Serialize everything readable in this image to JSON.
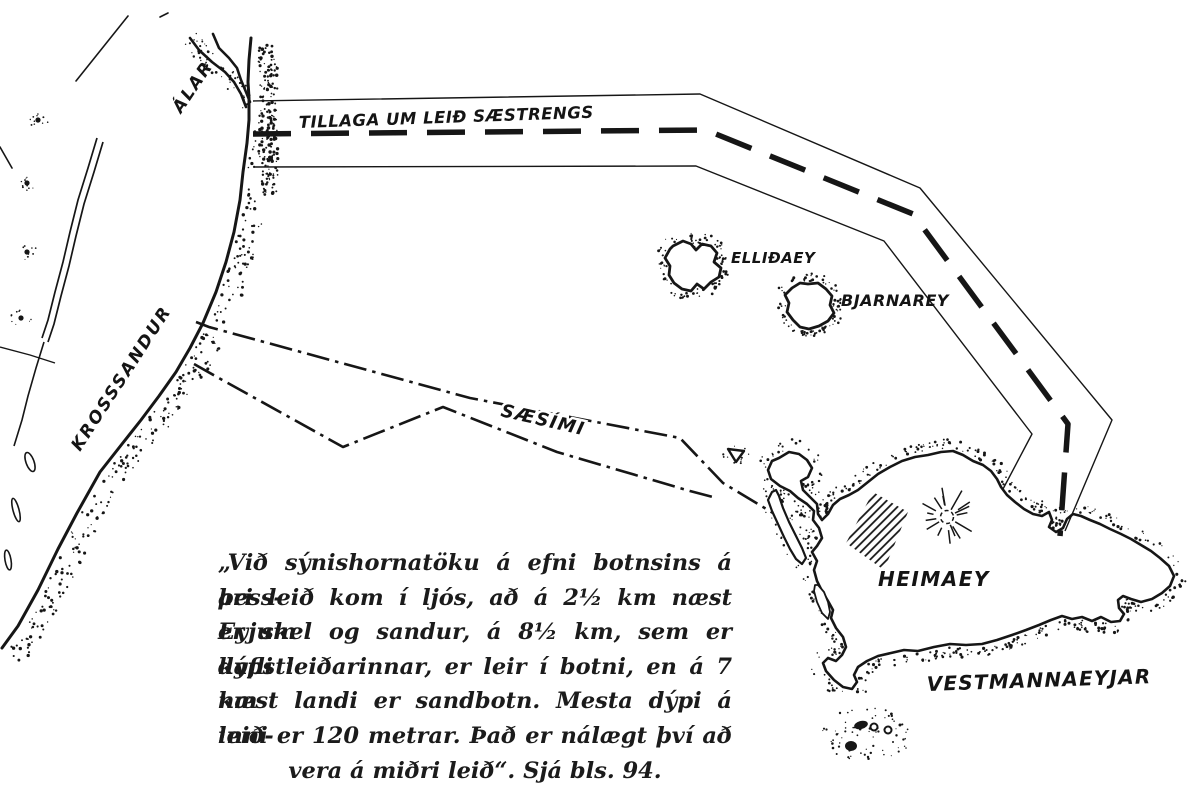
{
  "colors": {
    "ink": "#161616",
    "paper": "#ffffff"
  },
  "labels": {
    "alar": "ÁLAR",
    "tillaga": "TILLAGA UM LEIÐ SÆSTRENGS",
    "krosssandur": "KROSSSANDUR",
    "saesimi": "SÆSÍMI",
    "ellidaey": "ELLIÐAEY",
    "bjarnarey": "BJARNAREY",
    "heimaey": "HEIMAEY",
    "vestmannaeyjar": "VESTMANNAEYJAR"
  },
  "caption": {
    "lines": [
      "„Við sýnishornatöku á efni botnsins á þess-",
      "ari leið kom í ljós, að á 2½ km næst Eyjum",
      "er skel og sandur, á 8½ km, sem er dýpsti",
      "kafli leiðarinnar, er leir í botni, en á 7 km",
      "næst landi er sandbotn. Mesta dýpi á leið-",
      "inni er 120 metrar. Það er nálægt því að",
      "vera á miðri leið“. Sjá bls. 94."
    ]
  },
  "routes": {
    "proposed_sea_cable": {
      "label": "TILLAGA UM LEIÐ SÆSTRENGS",
      "style": "dashed",
      "center": [
        [
          253,
          134
        ],
        [
          706,
          130
        ],
        [
          913,
          214
        ],
        [
          1068,
          424
        ],
        [
          1060,
          536
        ]
      ],
      "upper": [
        [
          253,
          101
        ],
        [
          700,
          94
        ],
        [
          920,
          188
        ],
        [
          1112,
          420
        ],
        [
          1065,
          531
        ]
      ],
      "lower": [
        [
          255,
          167
        ],
        [
          696,
          166
        ],
        [
          884,
          241
        ],
        [
          1032,
          434
        ],
        [
          1003,
          489
        ]
      ]
    },
    "sea_telephone_upper": {
      "label": "SÆSÍMI",
      "style": "dash-dot",
      "points": [
        [
          196,
          322
        ],
        [
          209,
          327
        ],
        [
          470,
          398
        ],
        [
          680,
          438
        ],
        [
          723,
          483
        ],
        [
          773,
          513
        ]
      ]
    },
    "sea_telephone_lower": {
      "style": "dash-dot",
      "points": [
        [
          194,
          364
        ],
        [
          217,
          377
        ],
        [
          343,
          447
        ],
        [
          443,
          407
        ],
        [
          557,
          452
        ],
        [
          690,
          491
        ],
        [
          713,
          497
        ]
      ]
    }
  },
  "geometry": {
    "coast": [
      [
        251,
        38
      ],
      [
        249,
        60
      ],
      [
        248,
        82
      ],
      [
        249,
        98
      ],
      [
        249,
        120
      ],
      [
        247,
        143
      ],
      [
        243,
        172
      ],
      [
        240,
        200
      ],
      [
        234,
        232
      ],
      [
        226,
        262
      ],
      [
        216,
        292
      ],
      [
        203,
        323
      ],
      [
        190,
        348
      ],
      [
        176,
        372
      ],
      [
        159,
        396
      ],
      [
        141,
        420
      ],
      [
        122,
        444
      ],
      [
        100,
        472
      ],
      [
        77,
        513
      ],
      [
        58,
        549
      ],
      [
        38,
        590
      ],
      [
        18,
        626
      ],
      [
        2,
        648
      ]
    ],
    "channel": [
      [
        [
          190,
          38
        ],
        [
          199,
          50
        ],
        [
          212,
          62
        ],
        [
          225,
          72
        ],
        [
          234,
          82
        ],
        [
          241,
          94
        ],
        [
          246,
          107
        ]
      ],
      [
        [
          213,
          34
        ],
        [
          219,
          48
        ],
        [
          229,
          58
        ],
        [
          237,
          68
        ],
        [
          241,
          80
        ],
        [
          246,
          92
        ],
        [
          250,
          102
        ]
      ]
    ],
    "lagoon": {
      "outer": [
        [
          97,
          138
        ],
        [
          88,
          168
        ],
        [
          78,
          200
        ],
        [
          70,
          232
        ],
        [
          63,
          262
        ],
        [
          55,
          292
        ],
        [
          48,
          320
        ],
        [
          42,
          338
        ]
      ],
      "inner": [
        [
          103,
          142
        ],
        [
          94,
          172
        ],
        [
          84,
          204
        ],
        [
          76,
          236
        ],
        [
          69,
          266
        ],
        [
          61,
          296
        ],
        [
          54,
          324
        ],
        [
          48,
          342
        ]
      ],
      "tail": [
        [
          44,
          342
        ],
        [
          36,
          368
        ],
        [
          28,
          396
        ],
        [
          22,
          420
        ],
        [
          14,
          446
        ]
      ],
      "connector": [
        [
          0,
          347
        ],
        [
          30,
          355
        ],
        [
          55,
          363
        ]
      ],
      "blobs": [
        [
          30,
          462,
          4,
          10,
          -20
        ],
        [
          16,
          510,
          3,
          12,
          -15
        ],
        [
          8,
          560,
          3,
          10,
          -10
        ]
      ]
    },
    "ponds": [
      [
        38,
        120
      ],
      [
        27,
        183
      ],
      [
        27,
        252
      ],
      [
        21,
        318
      ]
    ],
    "misc_lines": [
      [
        [
          76,
          81
        ],
        [
          128,
          16
        ]
      ],
      [
        [
          160,
          17
        ],
        [
          168,
          13
        ]
      ],
      [
        [
          0,
          147
        ],
        [
          12,
          168
        ]
      ]
    ],
    "heimaey": [
      [
        779,
        458
      ],
      [
        789,
        452
      ],
      [
        799,
        454
      ],
      [
        807,
        460
      ],
      [
        812,
        468
      ],
      [
        808,
        477
      ],
      [
        801,
        481
      ],
      [
        803,
        490
      ],
      [
        810,
        497
      ],
      [
        817,
        504
      ],
      [
        818,
        514
      ],
      [
        822,
        520
      ],
      [
        828,
        514
      ],
      [
        833,
        505
      ],
      [
        840,
        499
      ],
      [
        849,
        495
      ],
      [
        858,
        490
      ],
      [
        868,
        482
      ],
      [
        878,
        474
      ],
      [
        890,
        467
      ],
      [
        902,
        461
      ],
      [
        915,
        457
      ],
      [
        928,
        455
      ],
      [
        941,
        452
      ],
      [
        953,
        451
      ],
      [
        963,
        455
      ],
      [
        973,
        461
      ],
      [
        983,
        465
      ],
      [
        991,
        471
      ],
      [
        997,
        479
      ],
      [
        1001,
        487
      ],
      [
        1007,
        495
      ],
      [
        1015,
        502
      ],
      [
        1024,
        509
      ],
      [
        1033,
        514
      ],
      [
        1042,
        516
      ],
      [
        1049,
        512
      ],
      [
        1052,
        520
      ],
      [
        1049,
        527
      ],
      [
        1056,
        532
      ],
      [
        1063,
        528
      ],
      [
        1067,
        519
      ],
      [
        1073,
        514
      ],
      [
        1081,
        516
      ],
      [
        1090,
        520
      ],
      [
        1100,
        524
      ],
      [
        1110,
        529
      ],
      [
        1121,
        534
      ],
      [
        1131,
        539
      ],
      [
        1141,
        545
      ],
      [
        1151,
        551
      ],
      [
        1160,
        558
      ],
      [
        1169,
        566
      ],
      [
        1174,
        576
      ],
      [
        1170,
        586
      ],
      [
        1162,
        593
      ],
      [
        1152,
        599
      ],
      [
        1141,
        602
      ],
      [
        1131,
        599
      ],
      [
        1123,
        596
      ],
      [
        1118,
        600
      ],
      [
        1119,
        608
      ],
      [
        1124,
        614
      ],
      [
        1120,
        621
      ],
      [
        1111,
        622
      ],
      [
        1101,
        617
      ],
      [
        1092,
        621
      ],
      [
        1082,
        617
      ],
      [
        1072,
        619
      ],
      [
        1062,
        616
      ],
      [
        1051,
        620
      ],
      [
        1039,
        625
      ],
      [
        1026,
        630
      ],
      [
        1012,
        635
      ],
      [
        997,
        640
      ],
      [
        982,
        644
      ],
      [
        966,
        645
      ],
      [
        950,
        644
      ],
      [
        934,
        647
      ],
      [
        918,
        651
      ],
      [
        904,
        650
      ],
      [
        891,
        653
      ],
      [
        878,
        656
      ],
      [
        867,
        661
      ],
      [
        858,
        667
      ],
      [
        854,
        675
      ],
      [
        857,
        682
      ],
      [
        852,
        689
      ],
      [
        843,
        687
      ],
      [
        834,
        680
      ],
      [
        826,
        671
      ],
      [
        823,
        663
      ],
      [
        828,
        658
      ],
      [
        836,
        661
      ],
      [
        842,
        655
      ],
      [
        846,
        647
      ],
      [
        843,
        637
      ],
      [
        836,
        628
      ],
      [
        831,
        618
      ],
      [
        833,
        610
      ],
      [
        828,
        601
      ],
      [
        822,
        591
      ],
      [
        817,
        581
      ],
      [
        814,
        570
      ],
      [
        817,
        561
      ],
      [
        812,
        552
      ],
      [
        817,
        546
      ],
      [
        822,
        538
      ],
      [
        819,
        528
      ],
      [
        813,
        520
      ],
      [
        814,
        511
      ],
      [
        807,
        504
      ],
      [
        798,
        498
      ],
      [
        790,
        491
      ],
      [
        780,
        486
      ],
      [
        771,
        479
      ],
      [
        768,
        470
      ],
      [
        772,
        461
      ],
      [
        779,
        458
      ]
    ],
    "west_strip": [
      [
        772,
        492
      ],
      [
        768,
        500
      ],
      [
        772,
        511
      ],
      [
        778,
        524
      ],
      [
        784,
        537
      ],
      [
        790,
        549
      ],
      [
        796,
        559
      ],
      [
        802,
        564
      ],
      [
        806,
        558
      ],
      [
        802,
        548
      ],
      [
        796,
        536
      ],
      [
        789,
        522
      ],
      [
        783,
        508
      ],
      [
        779,
        496
      ],
      [
        776,
        490
      ],
      [
        772,
        492
      ]
    ],
    "lagoon_loop": [
      [
        818,
        585
      ],
      [
        824,
        592
      ],
      [
        828,
        602
      ],
      [
        830,
        612
      ],
      [
        828,
        619
      ],
      [
        822,
        613
      ],
      [
        817,
        602
      ],
      [
        814,
        591
      ],
      [
        815,
        585
      ],
      [
        818,
        585
      ]
    ],
    "ellidaey": [
      [
        673,
        246
      ],
      [
        683,
        241
      ],
      [
        691,
        244
      ],
      [
        696,
        250
      ],
      [
        702,
        244
      ],
      [
        711,
        246
      ],
      [
        717,
        253
      ],
      [
        714,
        262
      ],
      [
        721,
        268
      ],
      [
        719,
        277
      ],
      [
        711,
        282
      ],
      [
        704,
        289
      ],
      [
        697,
        284
      ],
      [
        691,
        291
      ],
      [
        682,
        289
      ],
      [
        674,
        283
      ],
      [
        669,
        275
      ],
      [
        670,
        266
      ],
      [
        665,
        258
      ],
      [
        670,
        249
      ],
      [
        673,
        246
      ]
    ],
    "bjarnarey": [
      [
        808,
        284
      ],
      [
        818,
        283
      ],
      [
        826,
        289
      ],
      [
        832,
        296
      ],
      [
        830,
        305
      ],
      [
        834,
        313
      ],
      [
        828,
        321
      ],
      [
        819,
        326
      ],
      [
        809,
        329
      ],
      [
        800,
        327
      ],
      [
        793,
        320
      ],
      [
        787,
        312
      ],
      [
        789,
        303
      ],
      [
        785,
        295
      ],
      [
        792,
        288
      ],
      [
        800,
        283
      ],
      [
        808,
        284
      ]
    ],
    "islets": {
      "blobs": [
        [
          861,
          725,
          7,
          4,
          -15
        ],
        [
          851,
          746,
          6,
          5,
          0
        ]
      ],
      "rings": [
        [
          874,
          727,
          3.5
        ],
        [
          888,
          730,
          3.5
        ]
      ],
      "dots": [
        [
          840,
          713,
          1.2
        ],
        [
          900,
          725,
          1.5
        ],
        [
          868,
          757,
          1.2
        ],
        [
          833,
          748,
          1.3
        ],
        [
          893,
          742,
          1.0
        ],
        [
          906,
          748,
          0.8
        ]
      ]
    },
    "town_hatch": [
      [
        846,
        543
      ],
      [
        873,
        492
      ],
      [
        908,
        512
      ],
      [
        884,
        570
      ]
    ],
    "crater": {
      "cx": 947,
      "cy": 517
    },
    "triangle": [
      [
        728,
        449
      ],
      [
        744,
        451
      ],
      [
        736,
        462
      ]
    ]
  }
}
